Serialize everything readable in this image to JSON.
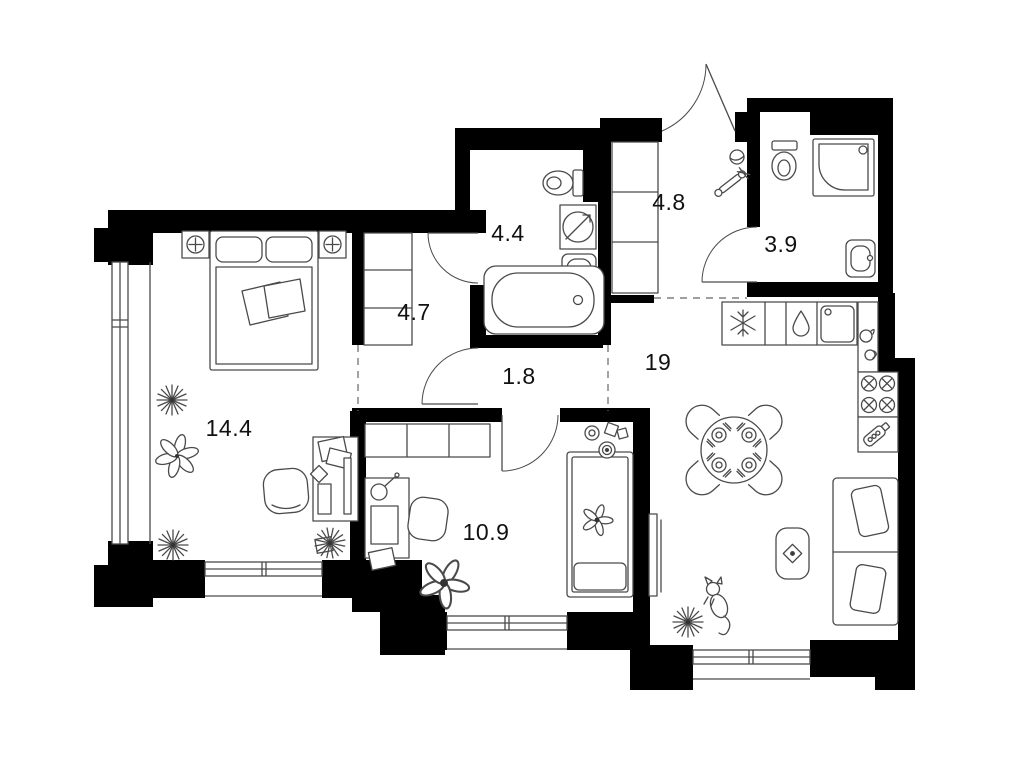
{
  "floorplan": {
    "rooms": [
      {
        "name": "bedroom",
        "area": "14.4"
      },
      {
        "name": "closet-hall",
        "area": "4.7"
      },
      {
        "name": "bathroom",
        "area": "4.4"
      },
      {
        "name": "hallway",
        "area": "1.8"
      },
      {
        "name": "entry-hall",
        "area": "4.8"
      },
      {
        "name": "shower-room",
        "area": "3.9"
      },
      {
        "name": "kitchen-living-room",
        "area": "19"
      },
      {
        "name": "bedroom-2",
        "area": "10.9"
      }
    ],
    "colors": {
      "wall": "#000000",
      "line": "#4a4a4a",
      "label": "#111111",
      "background": "#ffffff"
    }
  }
}
